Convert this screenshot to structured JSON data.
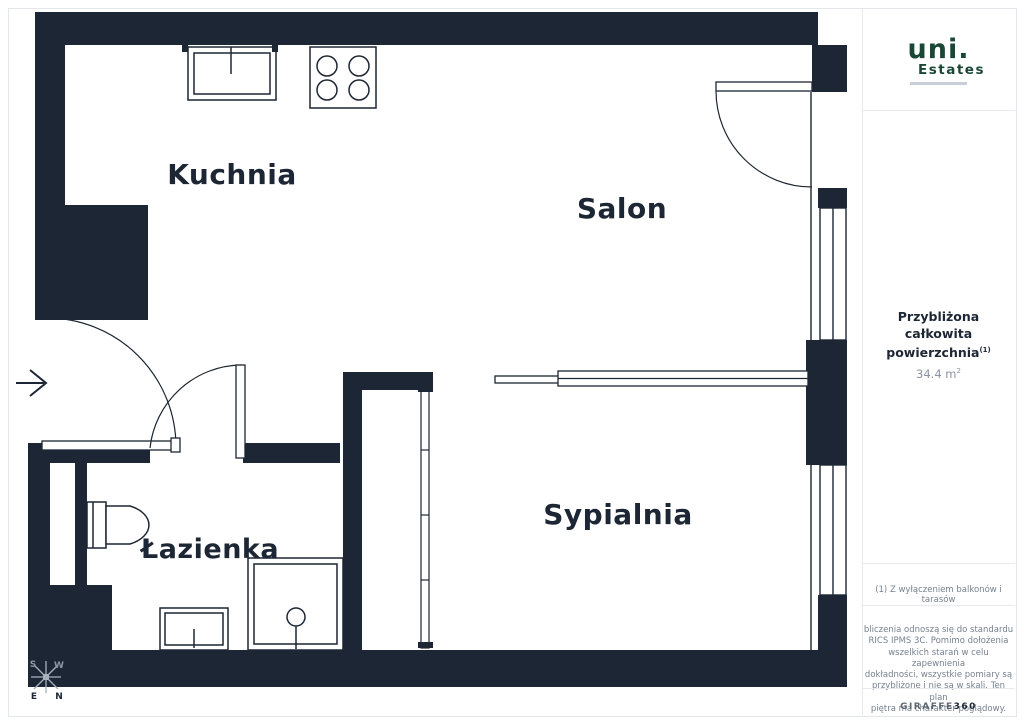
{
  "sidebar": {
    "logo": {
      "primary": "uni.",
      "secondary": "Estates"
    },
    "area": {
      "line1": "Przybliżona całkowita",
      "line2": "powierzchnia",
      "sup": "(1)",
      "value": "34.4 m",
      "value_sup": "2"
    },
    "footnote": "(1) Z wyłączeniem balkonów i tarasów",
    "disclaimer_lines": [
      "bliczenia odnoszą się do standardu",
      "RICS IPMS 3C. Pomimo dołożenia",
      "wszelkich starań w celu zapewnienia",
      "dokładności, wszystkie pomiary są",
      "przybliżone i nie są w skali. Ten plan",
      "piętra ma charakter poglądowy."
    ],
    "brand": {
      "light": "GIRAFFE",
      "bold": "360"
    }
  },
  "floorplan": {
    "rooms": {
      "kitchen": "Kuchnia",
      "living": "Salon",
      "bedroom": "Sypialnia",
      "bathroom": "Łazienka"
    },
    "compass": {
      "n": "N",
      "e": "E",
      "s": "S",
      "w": "W"
    }
  },
  "colors": {
    "wall": "#1d2634",
    "logo_green": "#1b4736",
    "muted_text": "#76818f",
    "divider": "#e7eaee",
    "compass_light": "#a7b1bc"
  }
}
